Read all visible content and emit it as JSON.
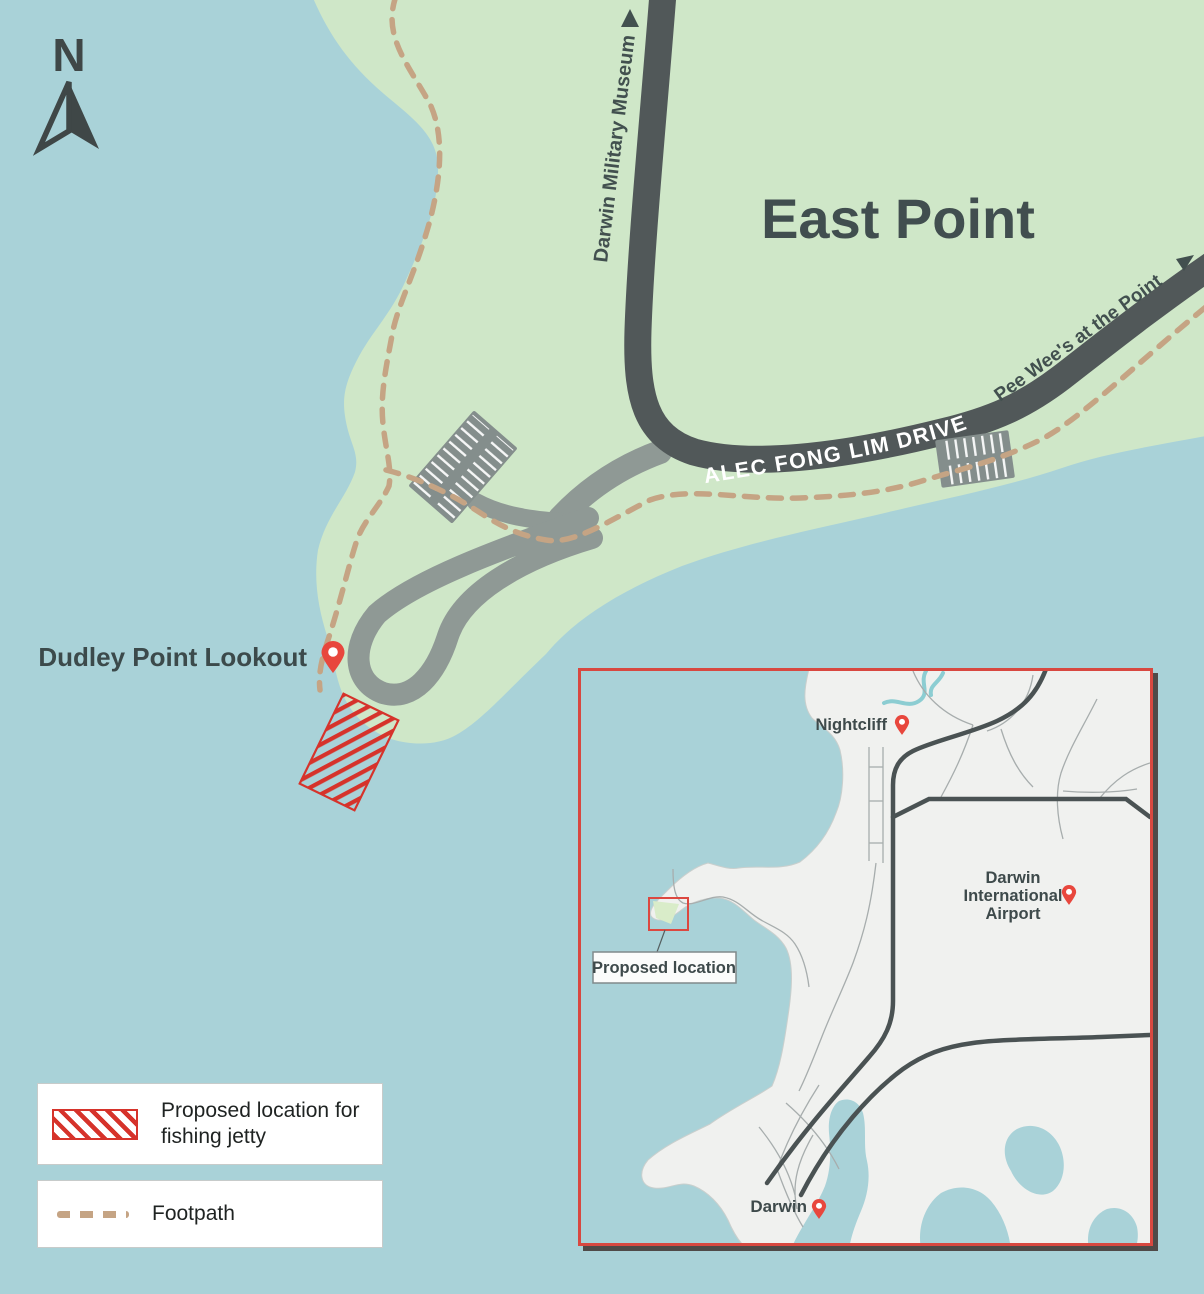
{
  "title": {
    "main_area": "East Point"
  },
  "compass": {
    "label": "N"
  },
  "roads": {
    "alec_fong_lim": "ALEC FONG LIM DRIVE",
    "museum_direction": "Darwin Military Museum",
    "pee_wees_direction": "Pee Wee's at the Point"
  },
  "poi": {
    "dudley_lookout": "Dudley Point Lookout"
  },
  "legend": {
    "jetty_line1": "Proposed location for",
    "jetty_line2": "fishing jetty",
    "footpath": "Footpath"
  },
  "inset": {
    "nightcliff": "Nightcliff",
    "airport": {
      "line1": "Darwin",
      "line2": "International",
      "line3": "Airport"
    },
    "darwin": "Darwin",
    "proposed_location": "Proposed location"
  },
  "colors": {
    "water": "#a9d2d8",
    "land": "#cfe7c8",
    "inset_land": "#f0f1ef",
    "road_dark": "#515859",
    "road_light": "#8f9995",
    "parking": "#848e8c",
    "footpath": "#c5a484",
    "marker_red": "#e8473d",
    "hatch_red": "#d6332b",
    "inset_border": "#d84840",
    "label_dark": "#3f4b4c"
  }
}
